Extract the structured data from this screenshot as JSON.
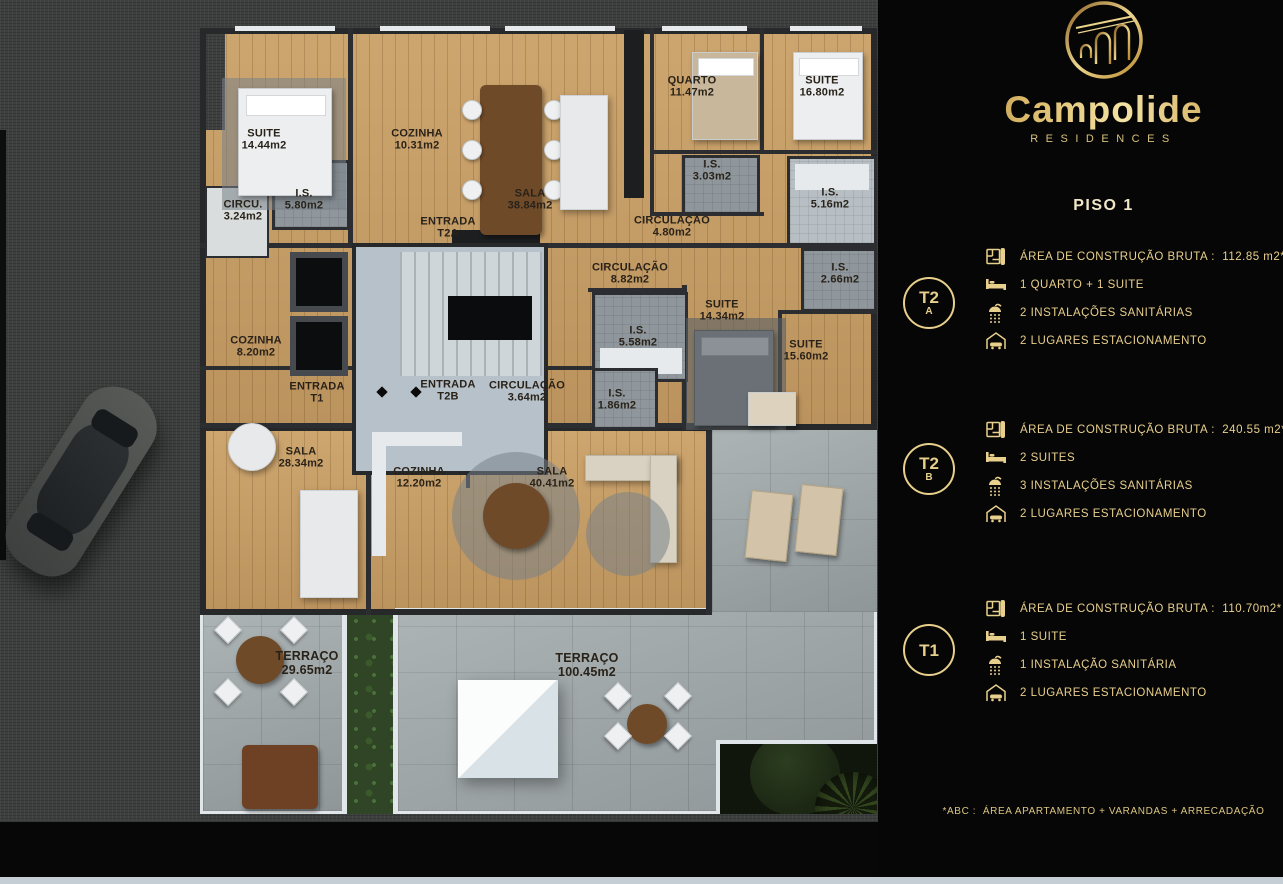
{
  "brand": {
    "name": "Campolide",
    "tagline": "RESIDENCES"
  },
  "floor_title": "PISO 1",
  "units": [
    {
      "id": "T2A",
      "badge_top": "T2",
      "badge_bottom": "A",
      "specs": {
        "area": "ÁREA DE CONSTRUÇÃO BRUTA :  112.85 m2*",
        "bedrooms": "1 QUARTO + 1 SUITE",
        "bathrooms": "2 INSTALAÇÕES SANITÁRIAS",
        "parking": "2 LUGARES ESTACIONAMENTO"
      }
    },
    {
      "id": "T2B",
      "badge_top": "T2",
      "badge_bottom": "B",
      "specs": {
        "area": "ÁREA DE CONSTRUÇÃO BRUTA :  240.55 m2*",
        "bedrooms": "2 SUITES",
        "bathrooms": "3 INSTALAÇÕES SANITÁRIAS",
        "parking": "2 LUGARES ESTACIONAMENTO"
      }
    },
    {
      "id": "T1",
      "badge_top": "T1",
      "badge_bottom": "",
      "specs": {
        "area": "ÁREA DE CONSTRUÇÃO BRUTA :  110.70m2*",
        "bedrooms": "1 SUITE",
        "bathrooms": "1 INSTALAÇÃO SANITÁRIA",
        "parking": "2 LUGARES ESTACIONAMENTO"
      }
    }
  ],
  "footnote": "*ABC :  ÁREA APARTAMENTO + VARANDAS + ARRECADAÇÃO",
  "colors": {
    "gold": "#e8cf8c",
    "panel_bg": "#060606",
    "wood": "#c79e66",
    "title_text": "#f0e6c8"
  },
  "plan": {
    "rooms": [
      {
        "name": "SUITE",
        "area": "14.44m2"
      },
      {
        "name": "COZINHA",
        "area": "10.31m2"
      },
      {
        "name": "I.S.",
        "area": "5.80m2"
      },
      {
        "name": "CIRCU.",
        "area": "3.24m2"
      },
      {
        "name": "ENTRADA",
        "area": "T2A"
      },
      {
        "name": "SALA",
        "area": "38.84m2"
      },
      {
        "name": "QUARTO",
        "area": "11.47m2"
      },
      {
        "name": "SUITE",
        "area": "16.80m2"
      },
      {
        "name": "I.S.",
        "area": "3.03m2"
      },
      {
        "name": "I.S.",
        "area": "5.16m2"
      },
      {
        "name": "CIRCULAÇÃO",
        "area": "4.80m2"
      },
      {
        "name": "CIRCULAÇÃO",
        "area": "8.82m2"
      },
      {
        "name": "I.S.",
        "area": "5.58m2"
      },
      {
        "name": "SUITE",
        "area": "14.34m2"
      },
      {
        "name": "I.S.",
        "area": "2.66m2"
      },
      {
        "name": "SUITE",
        "area": "15.60m2"
      },
      {
        "name": "COZINHA",
        "area": "8.20m2"
      },
      {
        "name": "ENTRADA",
        "area": "T1"
      },
      {
        "name": "ENTRADA",
        "area": "T2B"
      },
      {
        "name": "CIRCULAÇÃO",
        "area": "3.64m2"
      },
      {
        "name": "I.S.",
        "area": "1.86m2"
      },
      {
        "name": "SALA",
        "area": "28.34m2"
      },
      {
        "name": "COZINHA",
        "area": "12.20m2"
      },
      {
        "name": "SALA",
        "area": "40.41m2"
      },
      {
        "name": "TERRAÇO",
        "area": "29.65m2"
      },
      {
        "name": "TERRAÇO",
        "area": "100.45m2"
      }
    ]
  }
}
